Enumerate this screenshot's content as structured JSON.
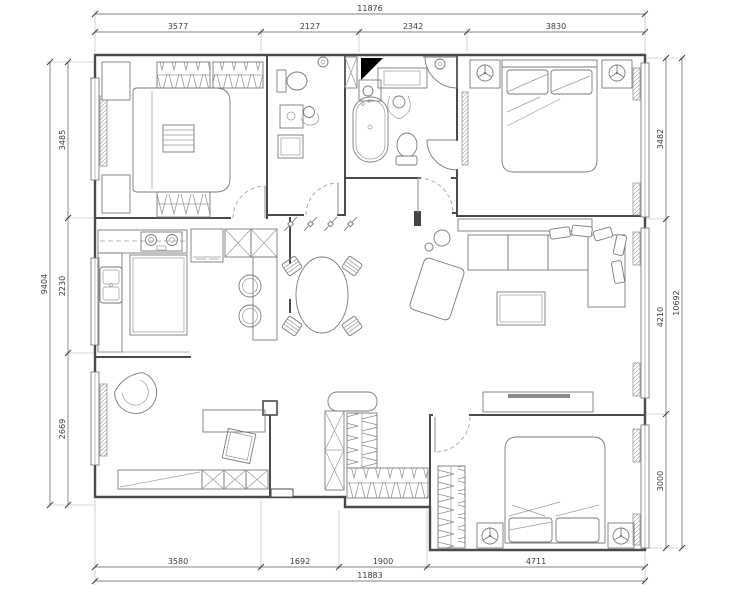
{
  "drawing": {
    "type": "apartment floor plan",
    "units": "mm"
  },
  "dims": {
    "top": {
      "overall": "11876",
      "segments": [
        "3577",
        "2127",
        "2342",
        "3830"
      ]
    },
    "bottom": {
      "overall": "11883",
      "segments": [
        "3580",
        "1692",
        "1900",
        "4711"
      ]
    },
    "left": {
      "overall": "9404",
      "segments": [
        "3485",
        "2230",
        "2669"
      ]
    },
    "right": {
      "overall": "10692",
      "segments": [
        "3482",
        "4210",
        "3000"
      ]
    }
  },
  "colors": {
    "background": "#ffffff",
    "wall_line": "#4a4a4a",
    "furniture_line": "#7a7a7a",
    "dimension_text": "#3c3c3c",
    "shaft_fill": "#000000"
  }
}
